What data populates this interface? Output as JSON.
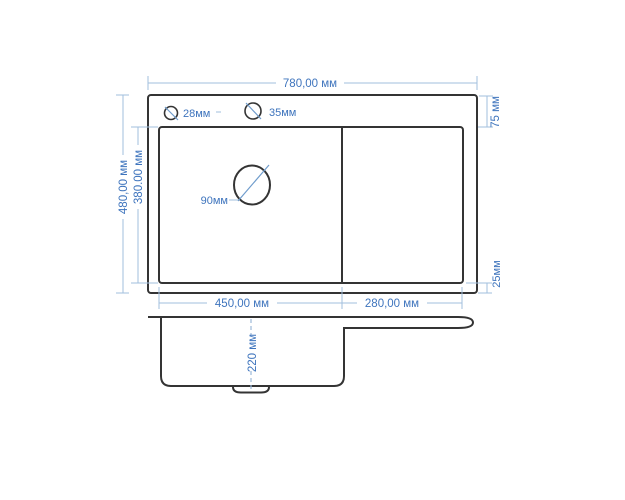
{
  "drawing": {
    "top_view": {
      "overall_width": "780,00 мм",
      "overall_height": "480,00 мм",
      "inner_height": "380.00 мм",
      "left_bowl_width": "450,00 мм",
      "right_bowl_width": "280,00 мм",
      "top_rim": "75 мм",
      "bottom_rim": "25мм",
      "hole_small": "28мм",
      "hole_large": "35мм",
      "drain": "90мм"
    },
    "side_view": {
      "bowl_depth": "220 мм"
    },
    "colors": {
      "outline": "#343434",
      "dimension_line": "#a2bfde",
      "dimension_text": "#3e74bd"
    }
  }
}
